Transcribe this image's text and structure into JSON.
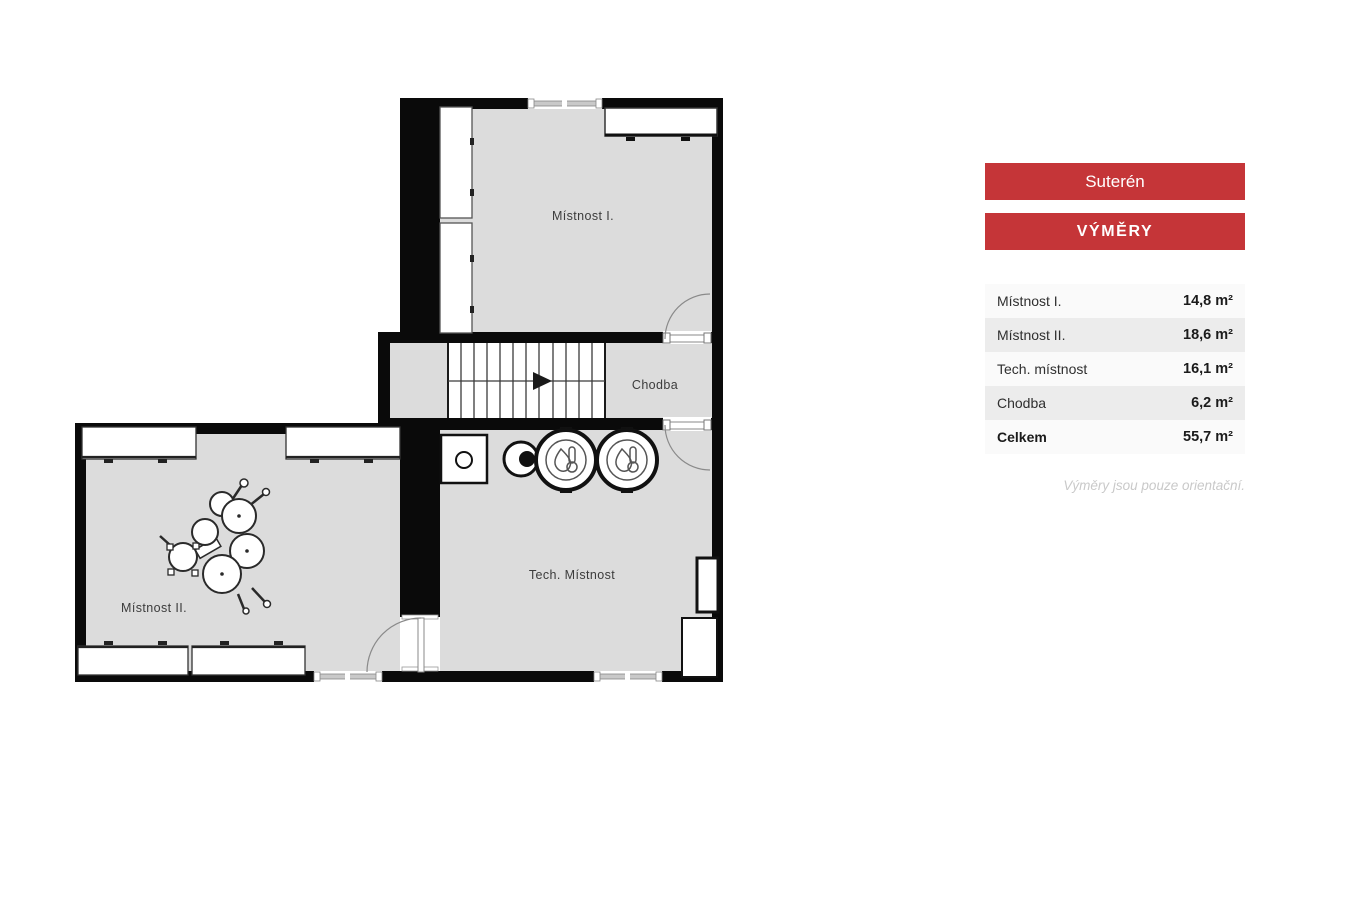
{
  "plan": {
    "rooms": {
      "room1": {
        "label": "Místnost I."
      },
      "room2": {
        "label": "Místnost II."
      },
      "tech": {
        "label": "Tech. Místnost"
      },
      "chodba": {
        "label": "Chodba"
      }
    }
  },
  "sidebar": {
    "floor_button_label": "Suterén",
    "areas_button_label": "VÝMĚRY",
    "table": {
      "rows": [
        {
          "label": "Místnost I.",
          "value": "14,8 m²"
        },
        {
          "label": "Místnost II.",
          "value": "18,6 m²"
        },
        {
          "label": "Tech. místnost",
          "value": "16,1 m²"
        },
        {
          "label": "Chodba",
          "value": "6,2 m²"
        },
        {
          "label": "Celkem",
          "value": "55,7 m²"
        }
      ]
    },
    "footnote": "Výměry jsou pouze orientační."
  },
  "colors": {
    "accent_red": "#c53538",
    "room_fill": "#dcdcdc",
    "wall": "#0a0a0a",
    "row_alt": "#ececec"
  }
}
